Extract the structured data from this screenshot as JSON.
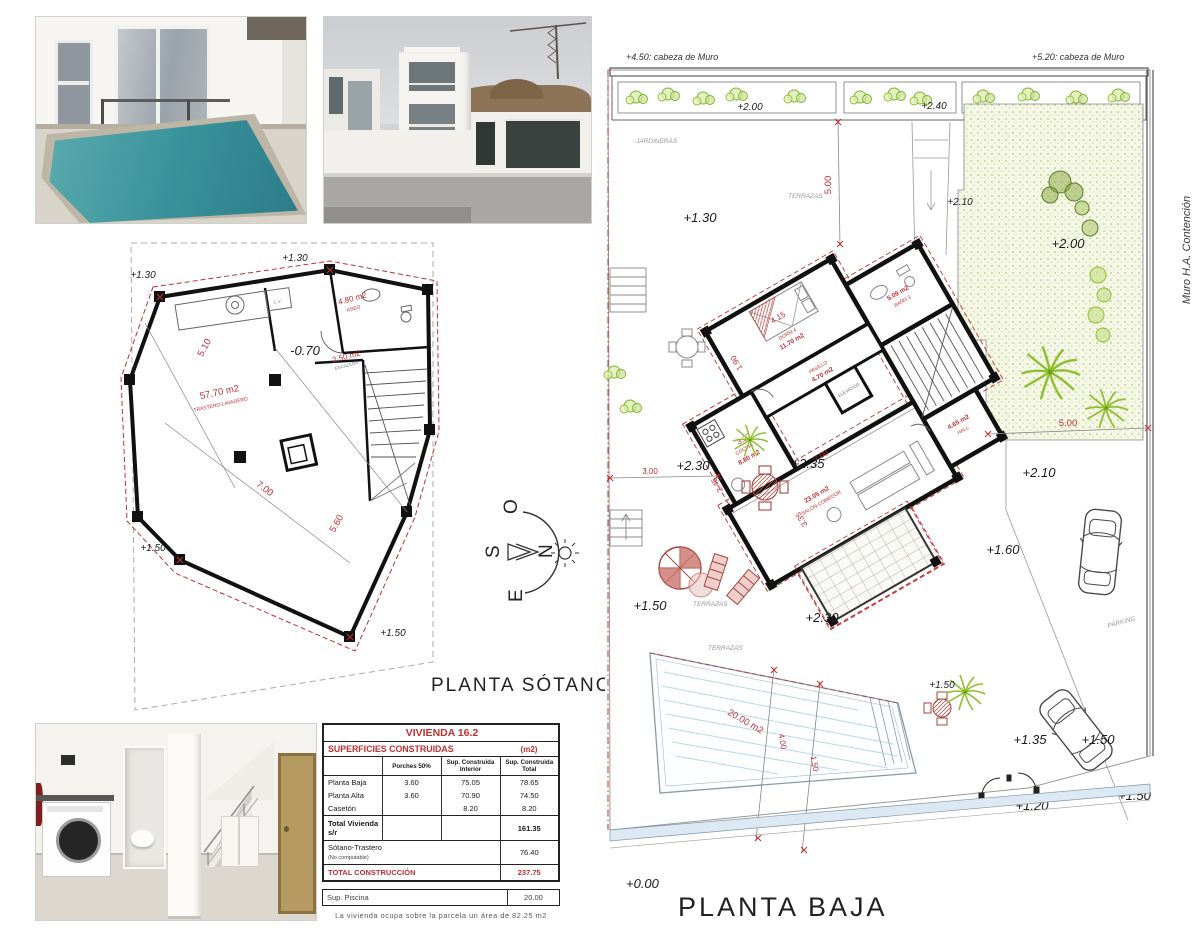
{
  "table": {
    "title": "VIVIENDA   16.2",
    "subtitle": "SUPERFICIES  CONSTRUIDAS",
    "unit": "(m2)",
    "col_porches": "Porches 50%",
    "col_interior": "Sup. Construida Interior",
    "col_total": "Sup. Construida Total",
    "rows": [
      {
        "label": "Planta Baja",
        "porches": "3.60",
        "interior": "75.05",
        "total": "78.65"
      },
      {
        "label": "Planta Alta",
        "porches": "3.60",
        "interior": "70.90",
        "total": "74.50"
      },
      {
        "label": "Casetón",
        "porches": "",
        "interior": "8.20",
        "total": "8.20"
      }
    ],
    "total_label": "Total Vivienda s/r",
    "total_value": "161.35",
    "sotano_label": "Sótano-Trastero",
    "sotano_note": "(No computable)",
    "sotano_value": "76.40",
    "construccion_label": "TOTAL CONSTRUCCIÓN",
    "construccion_value": "237.75",
    "piscina_label": "Sup. Piscina",
    "piscina_value": "20.00",
    "footnote": "La vivienda ocupa sobre la parcela un área de 82.25 m2"
  },
  "sotano": {
    "title": "PLANTA SÓTANO",
    "room_main_area": "57.70 m2",
    "room_main_name": "TRASTERO-LAVADERO",
    "room_aseo_area": "4.80 m2",
    "room_aseo_name": "ASEO",
    "room_stairs_area": "2.50 m2",
    "room_stairs_name": "ESCALERA",
    "lv": "L.V.",
    "level_tl": "+1.30",
    "level_tm": "+1.30",
    "level_mid": "-0.70",
    "level_bl": "+1.50",
    "level_br": "+1.50",
    "dim_left": "5.10",
    "dim_bottom": "7.00",
    "dim_cross": "5.60"
  },
  "baja": {
    "title": "PLANTA BAJA",
    "note_left": "+4.50: cabeza de Muro",
    "note_right": "+5.20: cabeza de Muro",
    "muro": "Muro H.A. Contención",
    "jardineras": "JARDINERAS",
    "terrazas_top": "TERRAZAS",
    "terrazas_left": "TERRAZAS",
    "terrazas_low": "TERRAZAS",
    "parking": "PARKING",
    "planter1": "+2.00",
    "planter2": "+2.40",
    "planter3": "+2.70",
    "lv_130": "+1.30",
    "lv_210a": "+2.10",
    "lv_200": "+2.00",
    "lv_210b": "+2.10",
    "lv_230a": "+2.30",
    "lv_235": "+2.35",
    "lv_230b": "+2.30",
    "lv_150a": "+1.50",
    "lv_160": "+1.60",
    "lv_150e": "+1.50",
    "lv_135": "+1.35",
    "lv_150c": "+1.50",
    "lv_120": "+1.20",
    "lv_150d": "+1.50",
    "lv_000": "+0.00",
    "dim_5a": "5.00",
    "dim_3": "3.00",
    "dim_5b": "5.00",
    "pool_area": "20.00 m2",
    "pool_w": "4.00",
    "pool_s": "1.50",
    "rooms": {
      "dorm": {
        "name": "DORM 4",
        "area": "11.70 m2",
        "d1": "4.15",
        "d2": "1.90"
      },
      "bano": {
        "name": "BAÑO 3",
        "area": "5.09 m2"
      },
      "cocina": {
        "name": "COCINA",
        "area": "8.80 m2",
        "d1": "3.27",
        "d2": "2.45"
      },
      "pasillo": {
        "name": "PASILLO",
        "area": "4.70 m2"
      },
      "hall": {
        "name": "HALL",
        "area": "4.65 m2"
      },
      "salon": {
        "name": "SALÓN-COMEDOR",
        "area": "23.05 m2",
        "d1": "7.00",
        "d2": "3.35"
      },
      "elevador": "ELEVADOR"
    }
  },
  "compass": {
    "n": "N",
    "s": "S",
    "e": "E",
    "o": "O"
  }
}
